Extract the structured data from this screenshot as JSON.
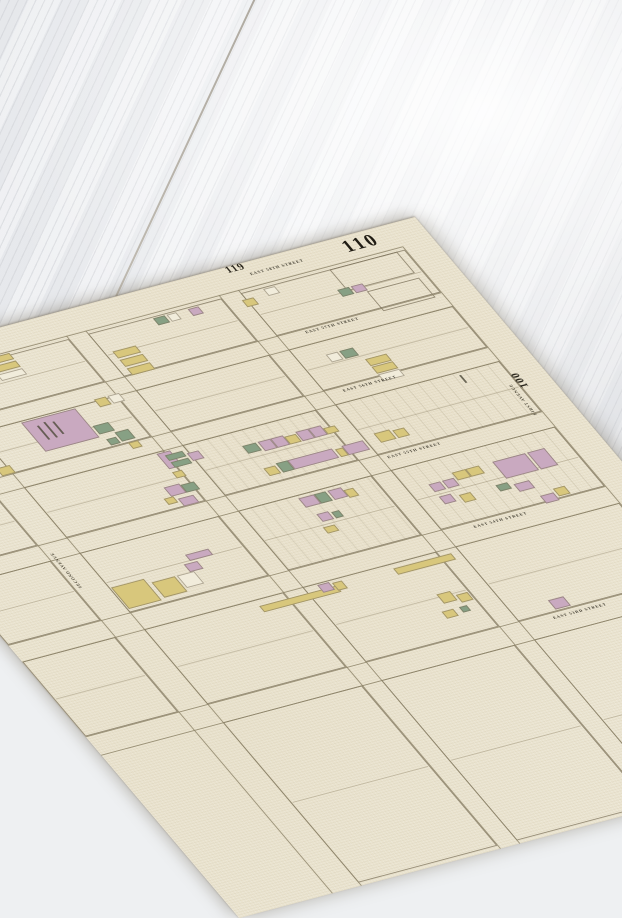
{
  "scene": {
    "surface": "white painted wood planks",
    "wood_color": "#f4f5f7",
    "seam_color": "#a8a298"
  },
  "map": {
    "paper_color": "#ebe5d2",
    "line_color": "#8d8468",
    "text_color": "#3e3a2e",
    "plate_number": "110",
    "adjacent_plate_top": "119",
    "adjacent_plate_right": "100",
    "lot_colors": {
      "p": "#c9a9c0",
      "y": "#d8c77c",
      "g": "#87a084",
      "w": "#f1ecdb"
    },
    "streets": [
      {
        "label": "EAST 58TH STREET",
        "x": 470,
        "y": 12,
        "lines": [
          28
        ]
      },
      {
        "label": "EAST 57TH STREET",
        "x": 475,
        "y": 90,
        "lines": [
          88,
          106
        ]
      },
      {
        "label": "EAST 56TH STREET",
        "x": 465,
        "y": 163,
        "lines": [
          160,
          178
        ]
      },
      {
        "label": "EAST 55TH STREET",
        "x": 455,
        "y": 247,
        "lines": [
          244,
          264
        ]
      },
      {
        "label": "EAST 54TH STREET",
        "x": 478,
        "y": 346,
        "lines": [
          342,
          364
        ]
      },
      {
        "label": "EAST 53RD STREET",
        "x": 480,
        "y": 466,
        "lines": [
          462,
          486
        ]
      }
    ],
    "avenues": [
      {
        "label": "SECOND AVENUE",
        "x": 100,
        "y": 302,
        "lines": [
          96,
          126
        ]
      },
      {
        "label": "FIRST AVENUE",
        "x": 608,
        "y": 246,
        "lines": [
          618
        ]
      }
    ],
    "extra_avenue_lines": [
      270,
      290,
      428,
      448
    ],
    "blocks": [
      {
        "x": 126,
        "y": 32,
        "w": 144,
        "h": 56,
        "hatch": false
      },
      {
        "x": 290,
        "y": 32,
        "w": 138,
        "h": 56,
        "hatch": false
      },
      {
        "x": 448,
        "y": 32,
        "w": 170,
        "h": 56,
        "hatch": false
      },
      {
        "x": 540,
        "y": 32,
        "w": 70,
        "h": 28,
        "hatch": false
      },
      {
        "x": 556,
        "y": 66,
        "w": 54,
        "h": 26,
        "hatch": false
      },
      {
        "x": 0,
        "y": 106,
        "w": 96,
        "h": 54,
        "hatch": false
      },
      {
        "x": 126,
        "y": 106,
        "w": 144,
        "h": 54,
        "hatch": false
      },
      {
        "x": 290,
        "y": 106,
        "w": 138,
        "h": 54,
        "hatch": false
      },
      {
        "x": 448,
        "y": 106,
        "w": 170,
        "h": 54,
        "hatch": false
      },
      {
        "x": 0,
        "y": 178,
        "w": 96,
        "h": 66,
        "hatch": false
      },
      {
        "x": 126,
        "y": 178,
        "w": 144,
        "h": 66,
        "hatch": false
      },
      {
        "x": 290,
        "y": 178,
        "w": 138,
        "h": 66,
        "hatch": true
      },
      {
        "x": 448,
        "y": 178,
        "w": 170,
        "h": 66,
        "hatch": true
      },
      {
        "x": 0,
        "y": 264,
        "w": 96,
        "h": 78,
        "hatch": false
      },
      {
        "x": 126,
        "y": 264,
        "w": 144,
        "h": 78,
        "hatch": false
      },
      {
        "x": 290,
        "y": 264,
        "w": 138,
        "h": 78,
        "hatch": true
      },
      {
        "x": 448,
        "y": 264,
        "w": 170,
        "h": 78,
        "hatch": true
      },
      {
        "x": 0,
        "y": 364,
        "w": 96,
        "h": 98,
        "hatch": false
      },
      {
        "x": 126,
        "y": 364,
        "w": 144,
        "h": 98,
        "hatch": false
      },
      {
        "x": 290,
        "y": 364,
        "w": 138,
        "h": 98,
        "hatch": false
      },
      {
        "x": 448,
        "y": 364,
        "w": 170,
        "h": 98,
        "hatch": false
      },
      {
        "x": 126,
        "y": 486,
        "w": 144,
        "h": 210,
        "hatch": false
      },
      {
        "x": 290,
        "y": 486,
        "w": 138,
        "h": 210,
        "hatch": false
      },
      {
        "x": 448,
        "y": 486,
        "w": 170,
        "h": 210,
        "hatch": false
      }
    ],
    "lots": [
      [
        356,
        34,
        12,
        9,
        "g"
      ],
      [
        370,
        34,
        10,
        9,
        "w"
      ],
      [
        392,
        34,
        11,
        9,
        "p"
      ],
      [
        444,
        40,
        12,
        9,
        "y"
      ],
      [
        470,
        34,
        12,
        9,
        "w"
      ],
      [
        532,
        56,
        12,
        9,
        "g"
      ],
      [
        546,
        56,
        12,
        9,
        "p"
      ],
      [
        184,
        30,
        26,
        8,
        "y"
      ],
      [
        184,
        40,
        26,
        8,
        "y"
      ],
      [
        184,
        50,
        26,
        8,
        "w"
      ],
      [
        298,
        58,
        24,
        9,
        "y"
      ],
      [
        298,
        69,
        24,
        9,
        "y"
      ],
      [
        298,
        80,
        24,
        9,
        "y"
      ],
      [
        248,
        104,
        12,
        10,
        "y"
      ],
      [
        262,
        104,
        12,
        10,
        "w"
      ],
      [
        116,
        150,
        14,
        10,
        "y"
      ],
      [
        170,
        108,
        56,
        38,
        "p"
      ],
      [
        228,
        132,
        16,
        11,
        "g"
      ],
      [
        242,
        145,
        14,
        12,
        "g"
      ],
      [
        230,
        150,
        10,
        8,
        "g"
      ],
      [
        246,
        160,
        10,
        8,
        "y"
      ],
      [
        476,
        122,
        12,
        10,
        "w"
      ],
      [
        490,
        122,
        14,
        10,
        "g"
      ],
      [
        506,
        138,
        22,
        9,
        "y"
      ],
      [
        506,
        148,
        22,
        9,
        "y"
      ],
      [
        506,
        158,
        22,
        9,
        "w"
      ],
      [
        262,
        180,
        14,
        20,
        "p"
      ],
      [
        268,
        184,
        18,
        7,
        "g"
      ],
      [
        268,
        193,
        18,
        7,
        "g"
      ],
      [
        288,
        188,
        12,
        10,
        "p"
      ],
      [
        262,
        204,
        10,
        8,
        "y"
      ],
      [
        340,
        196,
        14,
        10,
        "g"
      ],
      [
        356,
        196,
        13,
        12,
        "p"
      ],
      [
        369,
        196,
        13,
        12,
        "p"
      ],
      [
        382,
        198,
        12,
        10,
        "y"
      ],
      [
        395,
        196,
        13,
        12,
        "p"
      ],
      [
        408,
        196,
        13,
        12,
        "p"
      ],
      [
        421,
        200,
        12,
        8,
        "y"
      ],
      [
        342,
        226,
        12,
        10,
        "y"
      ],
      [
        356,
        224,
        12,
        12,
        "g"
      ],
      [
        368,
        224,
        46,
        12,
        "p"
      ],
      [
        416,
        226,
        8,
        10,
        "y"
      ],
      [
        424,
        224,
        22,
        12,
        "p"
      ],
      [
        460,
        220,
        16,
        12,
        "y"
      ],
      [
        478,
        222,
        12,
        10,
        "y"
      ],
      [
        350,
        268,
        16,
        12,
        "p"
      ],
      [
        366,
        268,
        12,
        12,
        "g"
      ],
      [
        380,
        268,
        14,
        12,
        "p"
      ],
      [
        394,
        272,
        10,
        10,
        "y"
      ],
      [
        354,
        290,
        12,
        10,
        "p"
      ],
      [
        368,
        292,
        8,
        8,
        "g"
      ],
      [
        350,
        306,
        12,
        8,
        "y"
      ],
      [
        244,
        218,
        16,
        12,
        "p"
      ],
      [
        260,
        220,
        14,
        10,
        "g"
      ],
      [
        248,
        234,
        16,
        10,
        "p"
      ],
      [
        236,
        230,
        10,
        8,
        "y"
      ],
      [
        540,
        284,
        34,
        22,
        "p"
      ],
      [
        576,
        284,
        18,
        22,
        "p"
      ],
      [
        470,
        290,
        12,
        10,
        "p"
      ],
      [
        484,
        290,
        12,
        10,
        "p"
      ],
      [
        498,
        284,
        14,
        10,
        "y"
      ],
      [
        512,
        284,
        14,
        10,
        "y"
      ],
      [
        470,
        306,
        12,
        10,
        "p"
      ],
      [
        488,
        310,
        12,
        10,
        "y"
      ],
      [
        526,
        310,
        12,
        8,
        "g"
      ],
      [
        542,
        314,
        16,
        10,
        "p"
      ],
      [
        556,
        334,
        14,
        10,
        "p"
      ],
      [
        572,
        330,
        12,
        10,
        "y"
      ],
      [
        128,
        310,
        34,
        28,
        "y"
      ],
      [
        166,
        316,
        24,
        20,
        "y"
      ],
      [
        192,
        316,
        18,
        16,
        "w"
      ],
      [
        206,
        306,
        14,
        10,
        "p"
      ],
      [
        214,
        296,
        24,
        8,
        "p"
      ],
      [
        240,
        372,
        80,
        8,
        "y"
      ],
      [
        304,
        366,
        12,
        10,
        "p"
      ],
      [
        318,
        368,
        10,
        10,
        "y"
      ],
      [
        380,
        370,
        60,
        8,
        "y"
      ],
      [
        398,
        410,
        14,
        12,
        "y"
      ],
      [
        414,
        416,
        12,
        10,
        "y"
      ],
      [
        408,
        430,
        8,
        7,
        "g"
      ],
      [
        390,
        430,
        12,
        9,
        "y"
      ],
      [
        488,
        448,
        16,
        12,
        "p"
      ]
    ],
    "marks": [
      [
        181,
        116,
        1.5,
        18
      ],
      [
        189,
        114,
        1.5,
        20
      ],
      [
        197,
        116,
        1.5,
        16
      ],
      [
        574,
        182,
        1.5,
        10
      ]
    ]
  }
}
